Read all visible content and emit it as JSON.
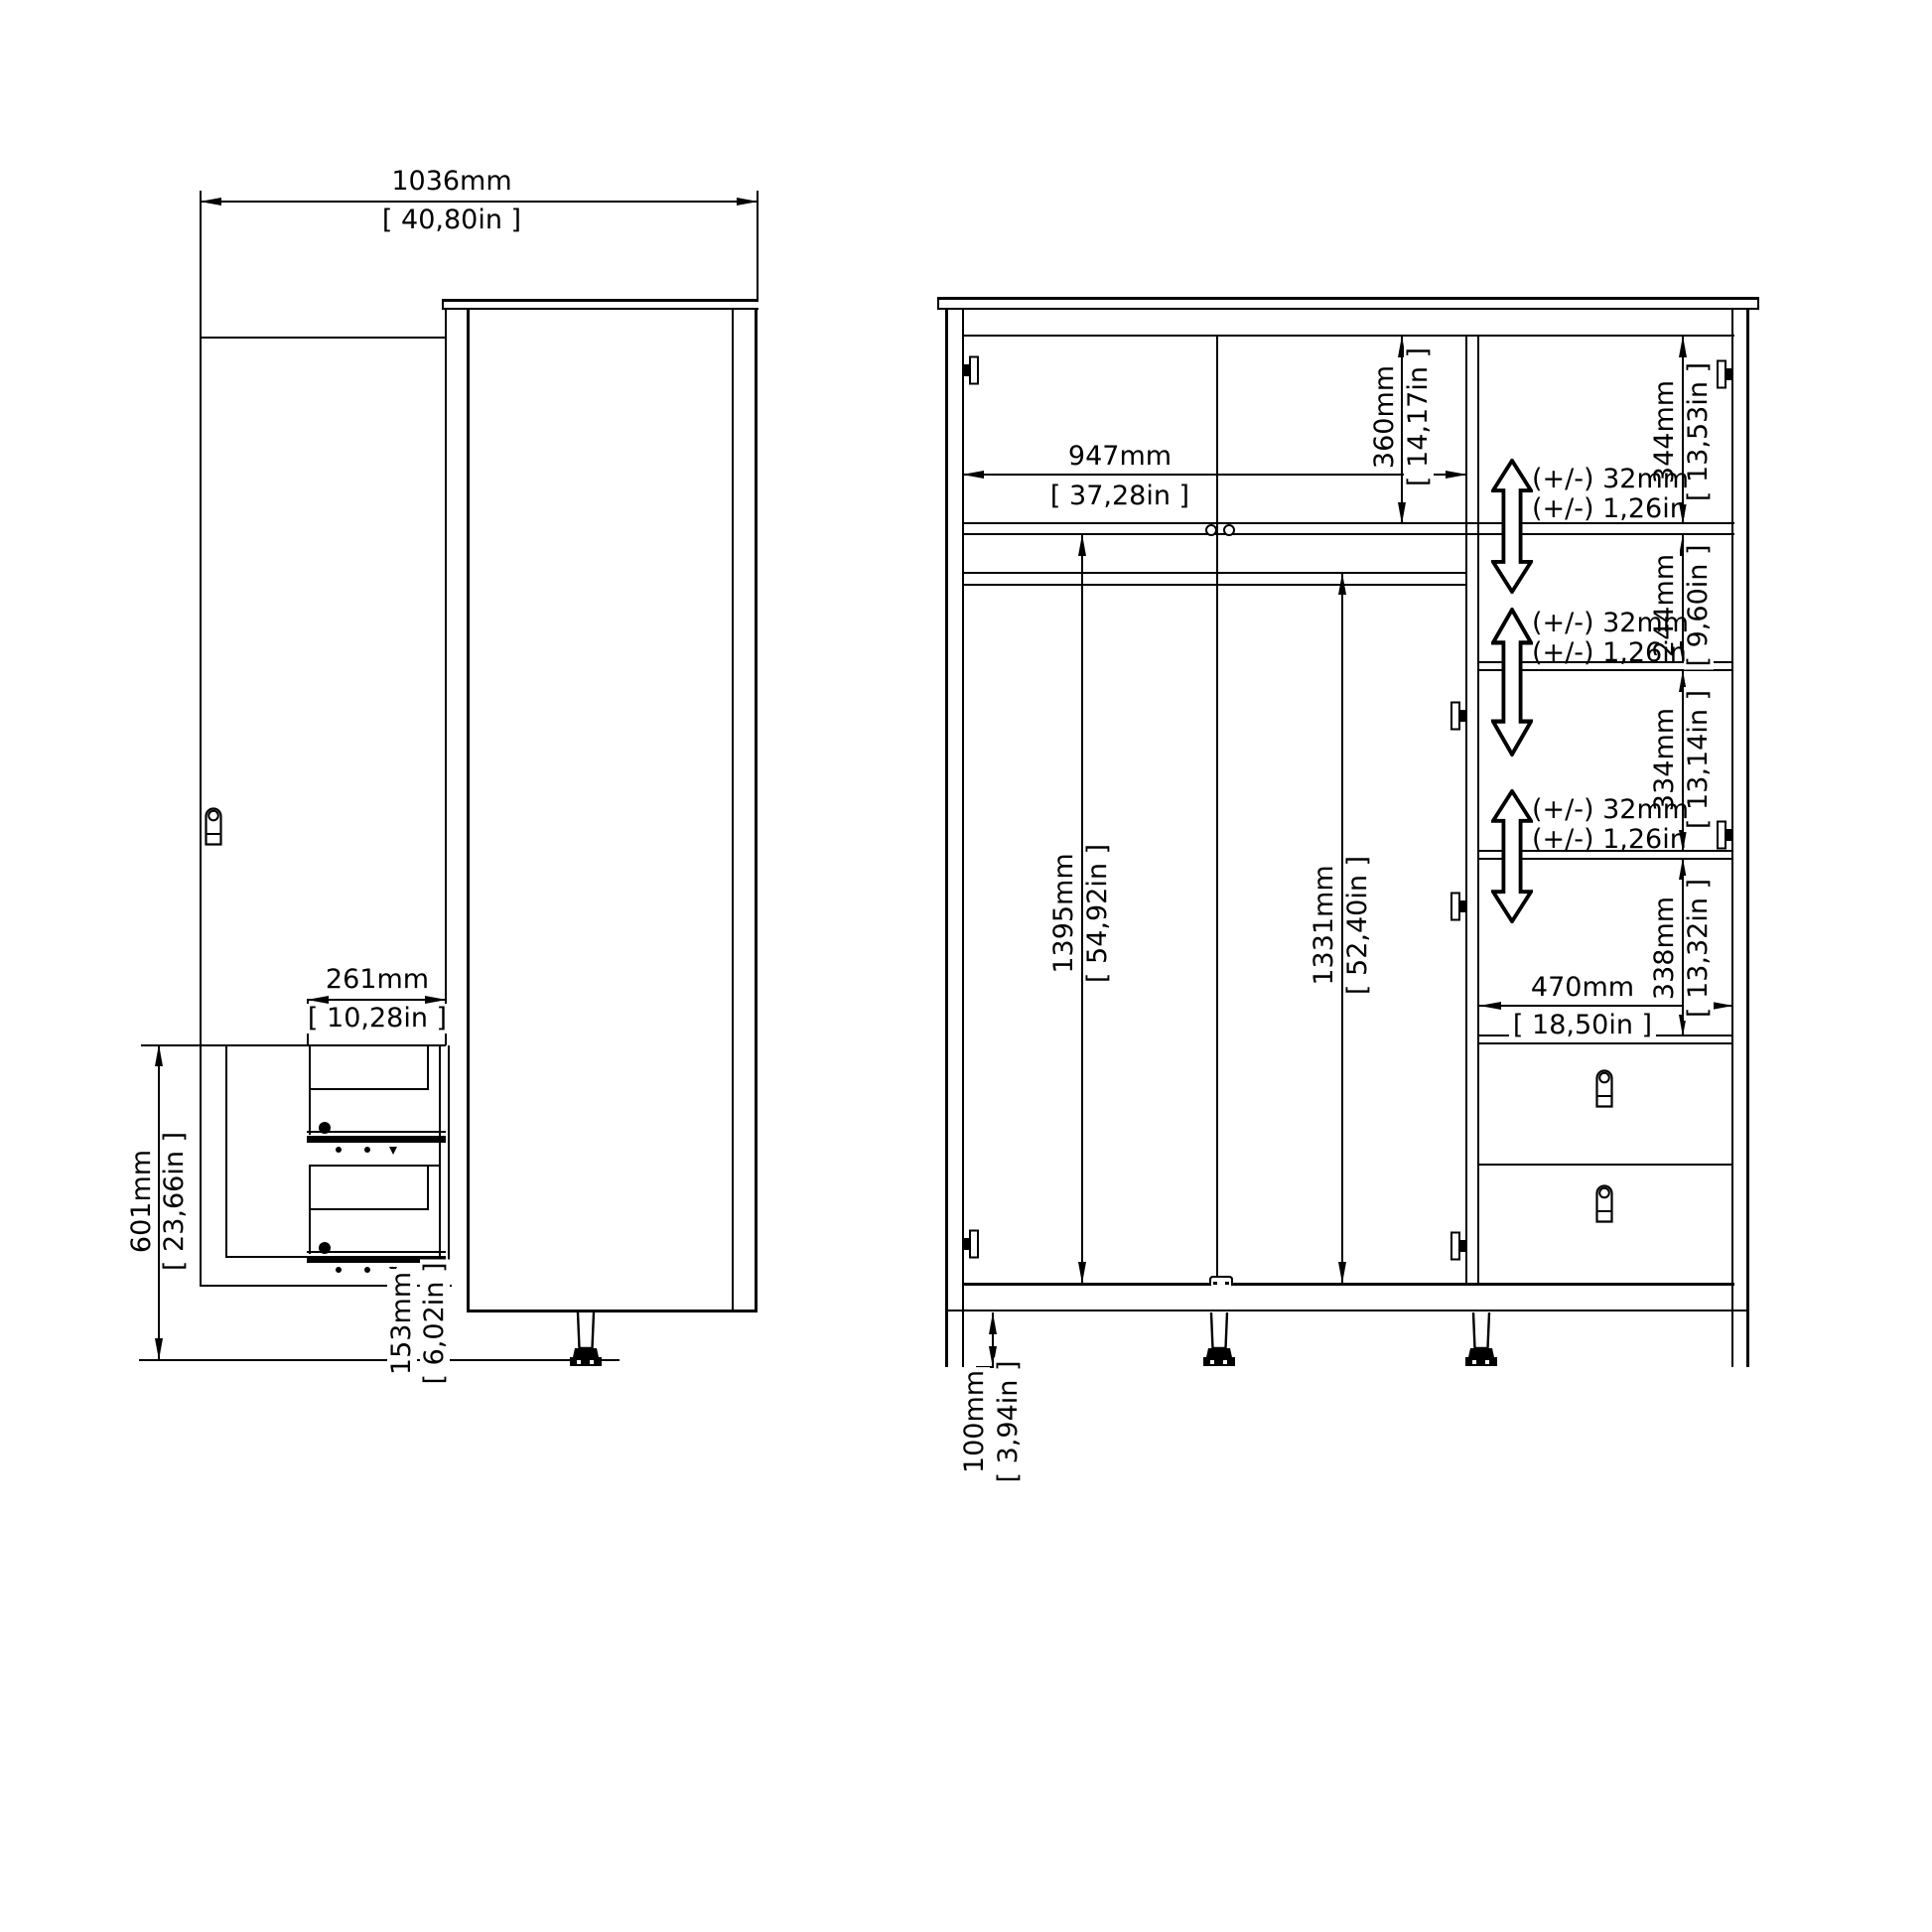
{
  "colors": {
    "line": "#000000",
    "background": "#ffffff"
  },
  "side_view": {
    "width": {
      "mm": "1036mm",
      "in": "[ 40,80in ]"
    },
    "drawer_depth": {
      "mm": "261mm",
      "in": "[ 10,28in ]"
    },
    "drawer_module_height": {
      "mm": "601mm",
      "in": "[ 23,66in ]"
    },
    "base_gap": {
      "mm": "153mm",
      "in": "[ 6,02in ]"
    }
  },
  "front_view": {
    "interior_width": {
      "mm": "947mm",
      "in": "[ 37,28in ]"
    },
    "top_section_height": {
      "mm": "360mm",
      "in": "[ 14,17in ]"
    },
    "left_interior_height": {
      "mm": "1395mm",
      "in": "[ 54,92in ]"
    },
    "rail_to_bottom": {
      "mm": "1331mm",
      "in": "[ 52,40in ]"
    },
    "shelf_space_1": {
      "mm": "344mm",
      "in": "[ 13,53in ]"
    },
    "shelf_space_2": {
      "mm": "244mm",
      "in": "[ 9,60in ]"
    },
    "shelf_space_3": {
      "mm": "334mm",
      "in": "[ 13,14in ]"
    },
    "shelf_space_4": {
      "mm": "338mm",
      "in": "[ 13,32in ]"
    },
    "right_interior_width": {
      "mm": "470mm",
      "in": "[ 18,50in ]"
    },
    "foot_height": {
      "mm": "100mm",
      "in": "[ 3,94in ]"
    },
    "shelf_adjust": {
      "line1": "(+/-) 32mm",
      "line2": "(+/-) 1,26in"
    }
  }
}
